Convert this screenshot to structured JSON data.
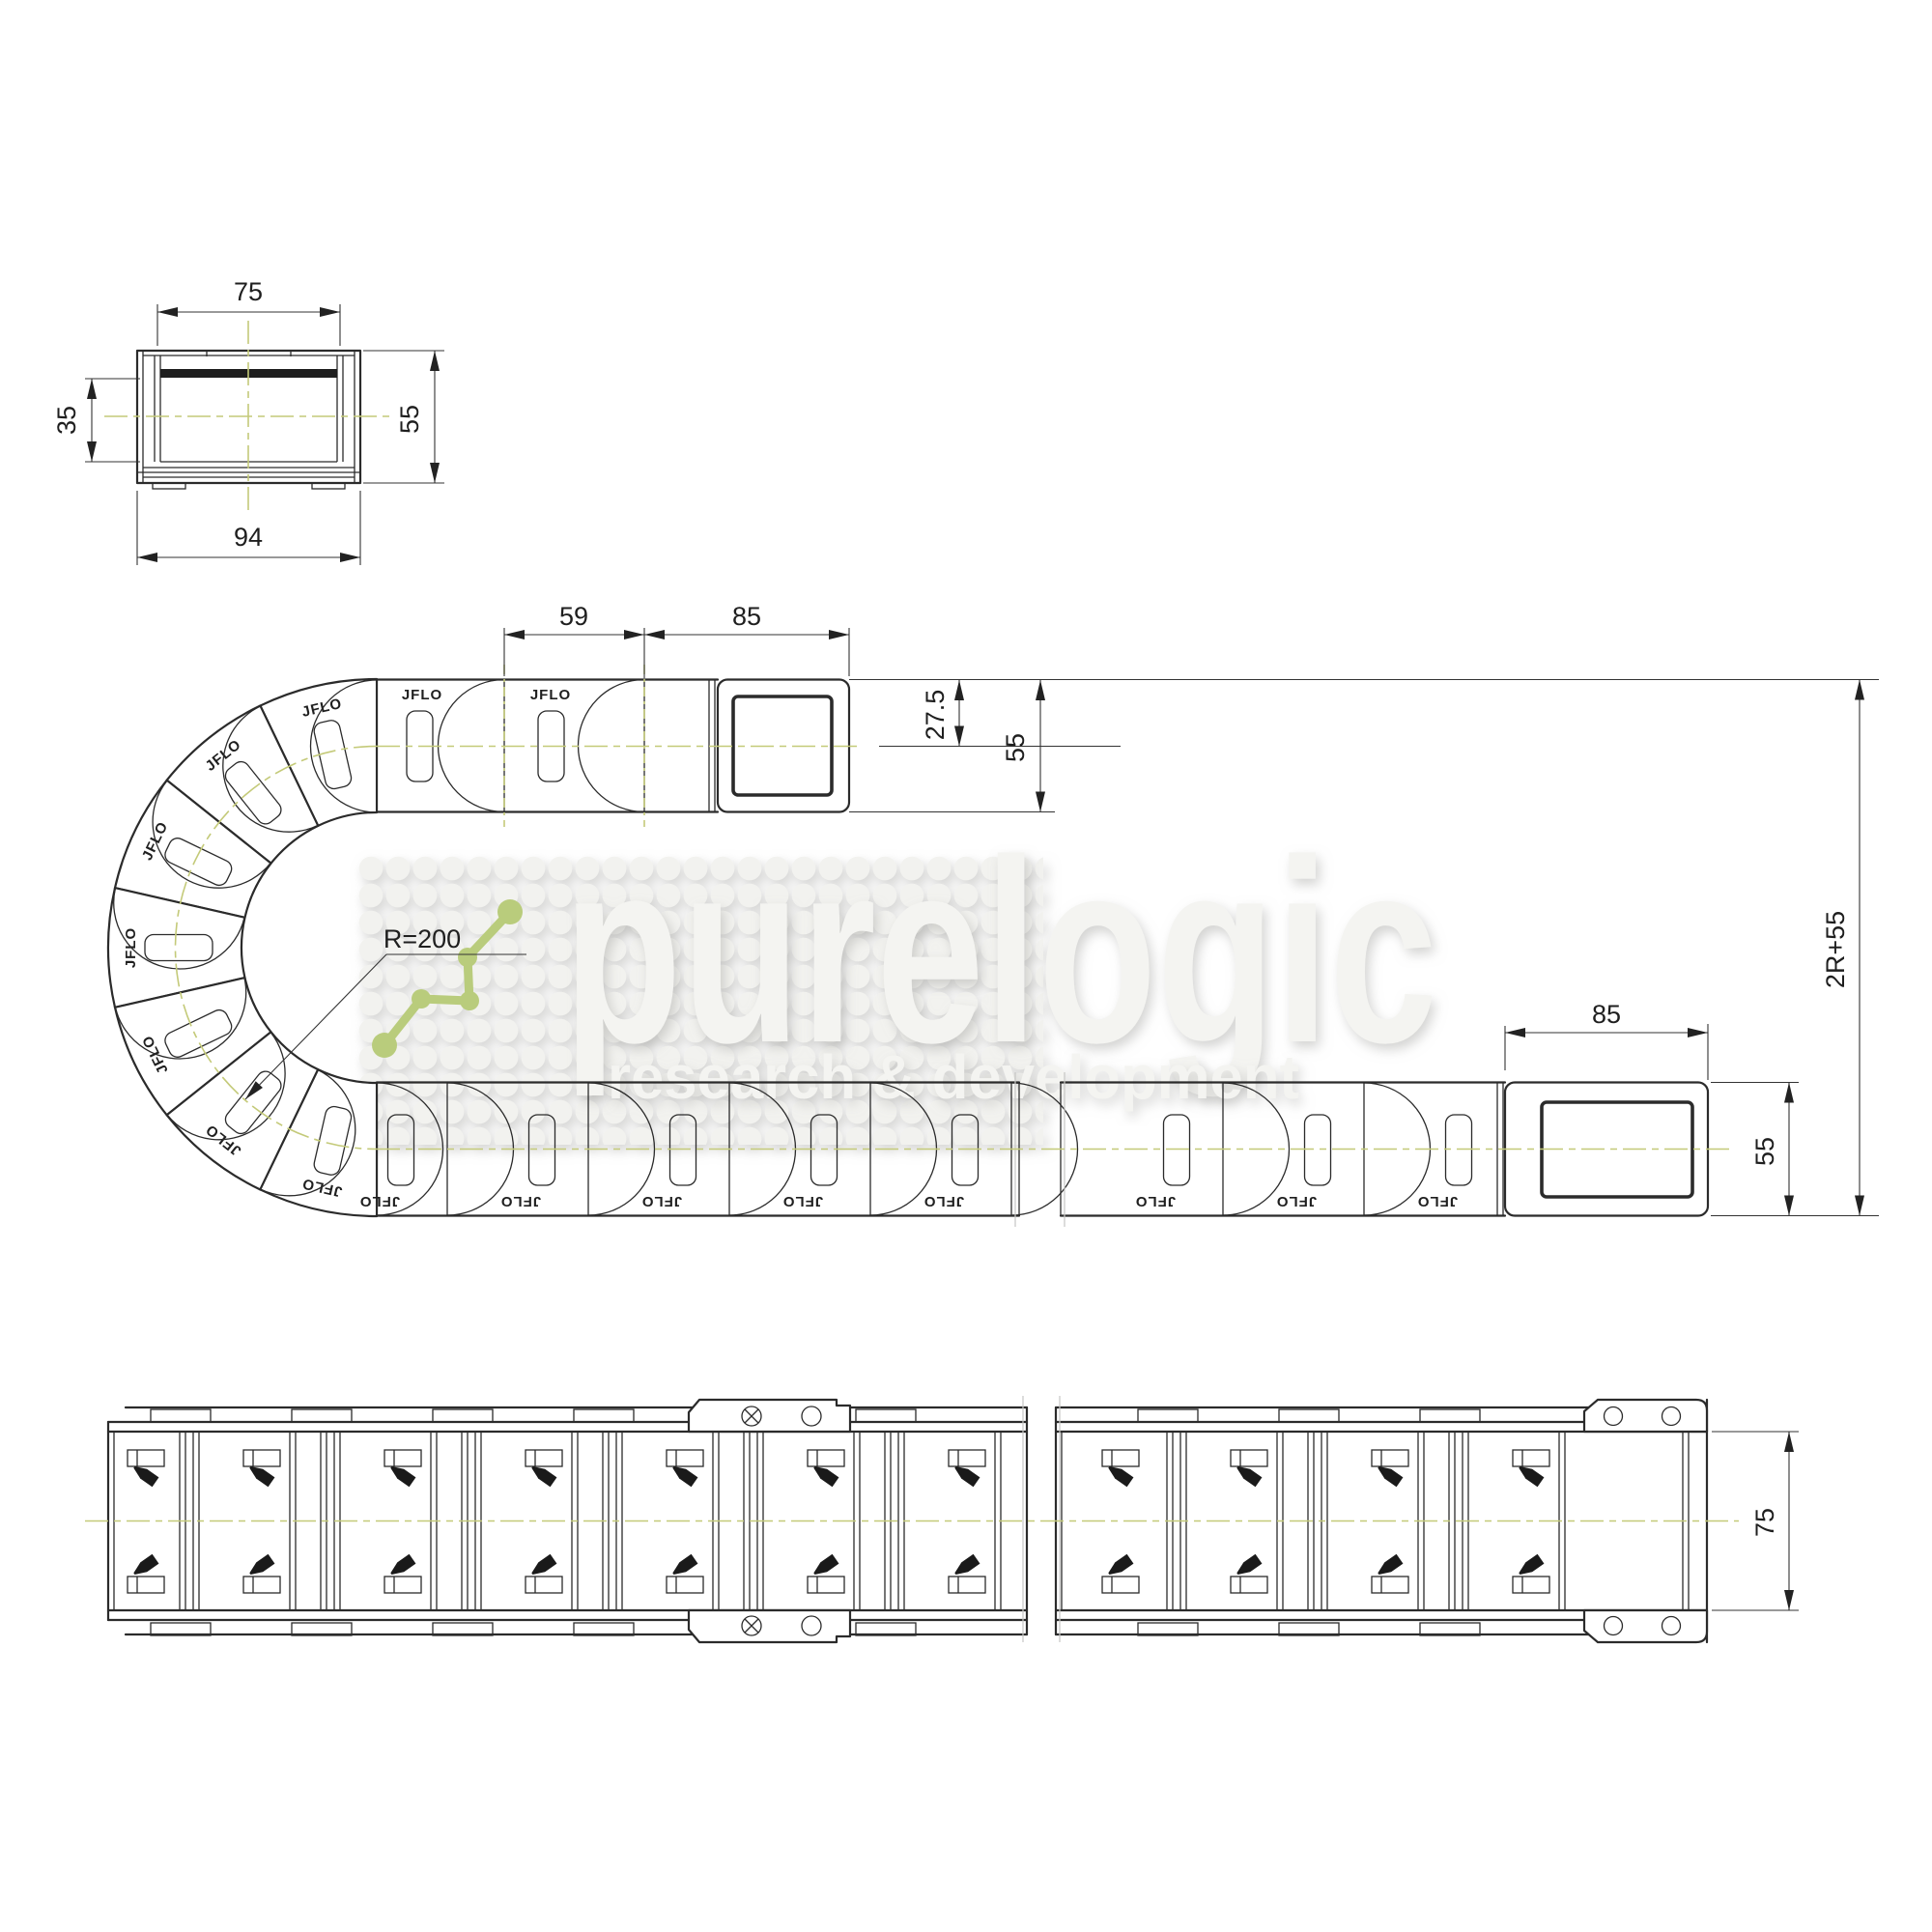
{
  "brand_label": "JFLO",
  "watermark": {
    "brand": "purelogic",
    "tagline": "research & development",
    "logo_color": "#b9cc7c",
    "text_color": "#f4f4f1"
  },
  "cross_section": {
    "dims": {
      "inner_width": "75",
      "inner_height": "35",
      "outer_width": "94",
      "outer_height": "55"
    }
  },
  "side_view": {
    "dims": {
      "link_pitch": "59",
      "moving_bracket_length": "85",
      "center_offset": "27.5",
      "chain_height": "55",
      "bend_radius": "R=200",
      "vertical_span": "2R+55",
      "fixed_bracket_length": "85",
      "fixed_end_height": "55"
    }
  },
  "plan_view": {
    "dims": {
      "chain_width": "75"
    }
  },
  "colors": {
    "centerline": "#c4ca79",
    "line": "#2b2b2b",
    "watermark_gray": "#f4f4f1"
  }
}
